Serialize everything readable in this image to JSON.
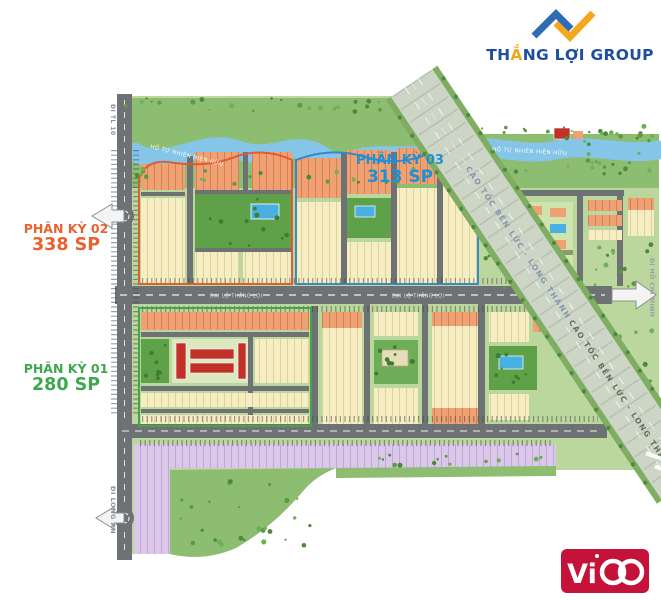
{
  "branding": {
    "thang_loi": {
      "part1": "TH",
      "part2": "Ắ",
      "part3": "NG LỢI GROUP",
      "text_color": "#1d4f9e",
      "mark_blue": "#2e6db6",
      "mark_orange": "#f4a71d"
    },
    "vico": {
      "brand": "ViCO",
      "prefix": "Vi",
      "bg_color": "#c41238"
    }
  },
  "phase_labels": {
    "pk03": {
      "title": "PHÂN KỲ 03",
      "units": "313 SP",
      "color": "#1e90d6"
    },
    "pk02": {
      "title": "PHÂN KỲ 02",
      "units": "338 SP",
      "color": "#e8622d"
    },
    "pk01": {
      "title": "PHÂN KỲ 01",
      "units": "280 SP",
      "color": "#3fa84f"
    }
  },
  "map_labels": {
    "river_left": "HỒ TỰ NHIÊN HIỆN HỮU",
    "river_right": "HỒ TỰ NHIÊN HIỆN HỮU",
    "highway_upper": "CAO TỐC BẾN LỨC - LONG THÀNH",
    "highway_lower": "CAO TỐC BẾN LỨC - LONG THÀNH",
    "boulevard_west": "ĐẠI LỘ THẮNG LỢI",
    "boulevard_east": "ĐẠI LỘ THẮNG LỢI",
    "exit_north": "ĐI TL 10",
    "exit_south": "ĐI LONG AN",
    "exit_east": "ĐI HỒ CHÍ MINH"
  }
}
